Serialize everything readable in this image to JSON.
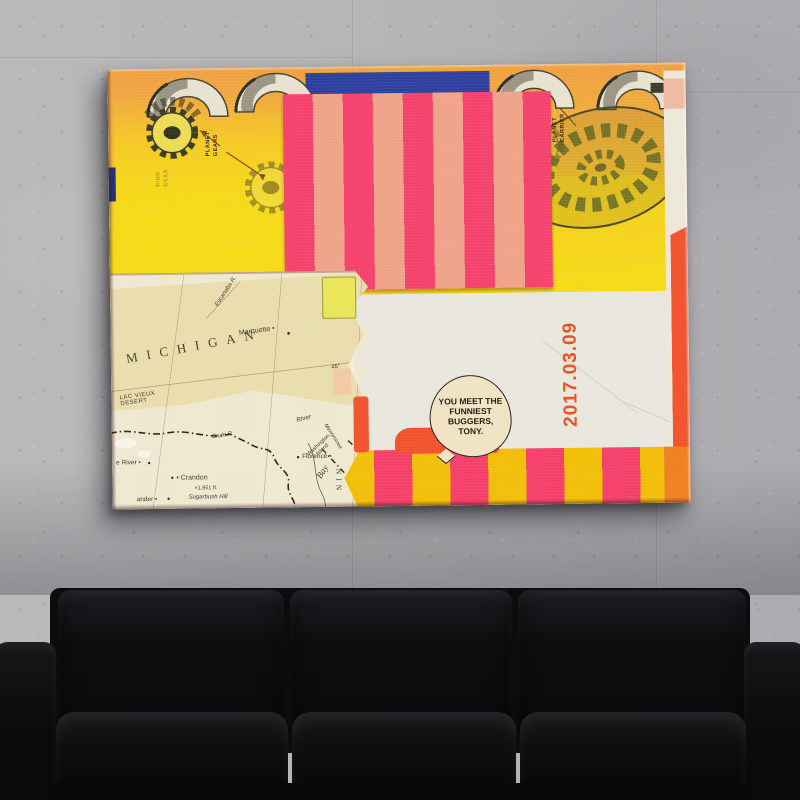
{
  "theme": {
    "wall": "#b5b4b6",
    "sofa_hi": "#1c1c20",
    "art_yellow": "#f6da15",
    "art_blue": "#2b3e9d",
    "stripe_pink": "#f4406a",
    "stripe_salmon": "#efa287",
    "band_yellow": "#f2bd05",
    "band_pink": "#f43e68",
    "band_orange": "#ef7f1d",
    "blob_red": "#f1512a",
    "map_cream": "#efe8d0",
    "map_tan": "#e7d9a2",
    "paper_white": "#e9e6dd",
    "date_red": "#e6501d",
    "magenta_edge": "#ce1270",
    "bubble_cream": "#f0e3c2"
  },
  "artwork": {
    "date_stamp": "2017.03.09",
    "speech_bubble": "YOU MEET THE FUNNIEST BUGGERS, TONY.",
    "gear_labels": {
      "planet_gears": "PLANET\nGEARS",
      "ring_gear": "RING\nGEAR",
      "planet_carrier": "PLANET\nCARRIER"
    },
    "map": {
      "state": "MICHIGAN",
      "marquette": "Marquette •",
      "lac_vieux_desert": "LAC VIEUX\nDESERT",
      "escanaba": "Escanaba R.",
      "brule": "Brule R.",
      "river": "River",
      "florence": "Florence •",
      "menominee": "Menominee",
      "crandon": "• Crandon",
      "elevation": "×1,951 ft.",
      "sugarbush": "Sugarbush Hill",
      "e_river": "e River •",
      "ander": "ander •",
      "washington_island": "Washington\nIsland",
      "bay": "Bay",
      "wisconsin_partial": "NIN",
      "parallel_45": "45°"
    }
  }
}
